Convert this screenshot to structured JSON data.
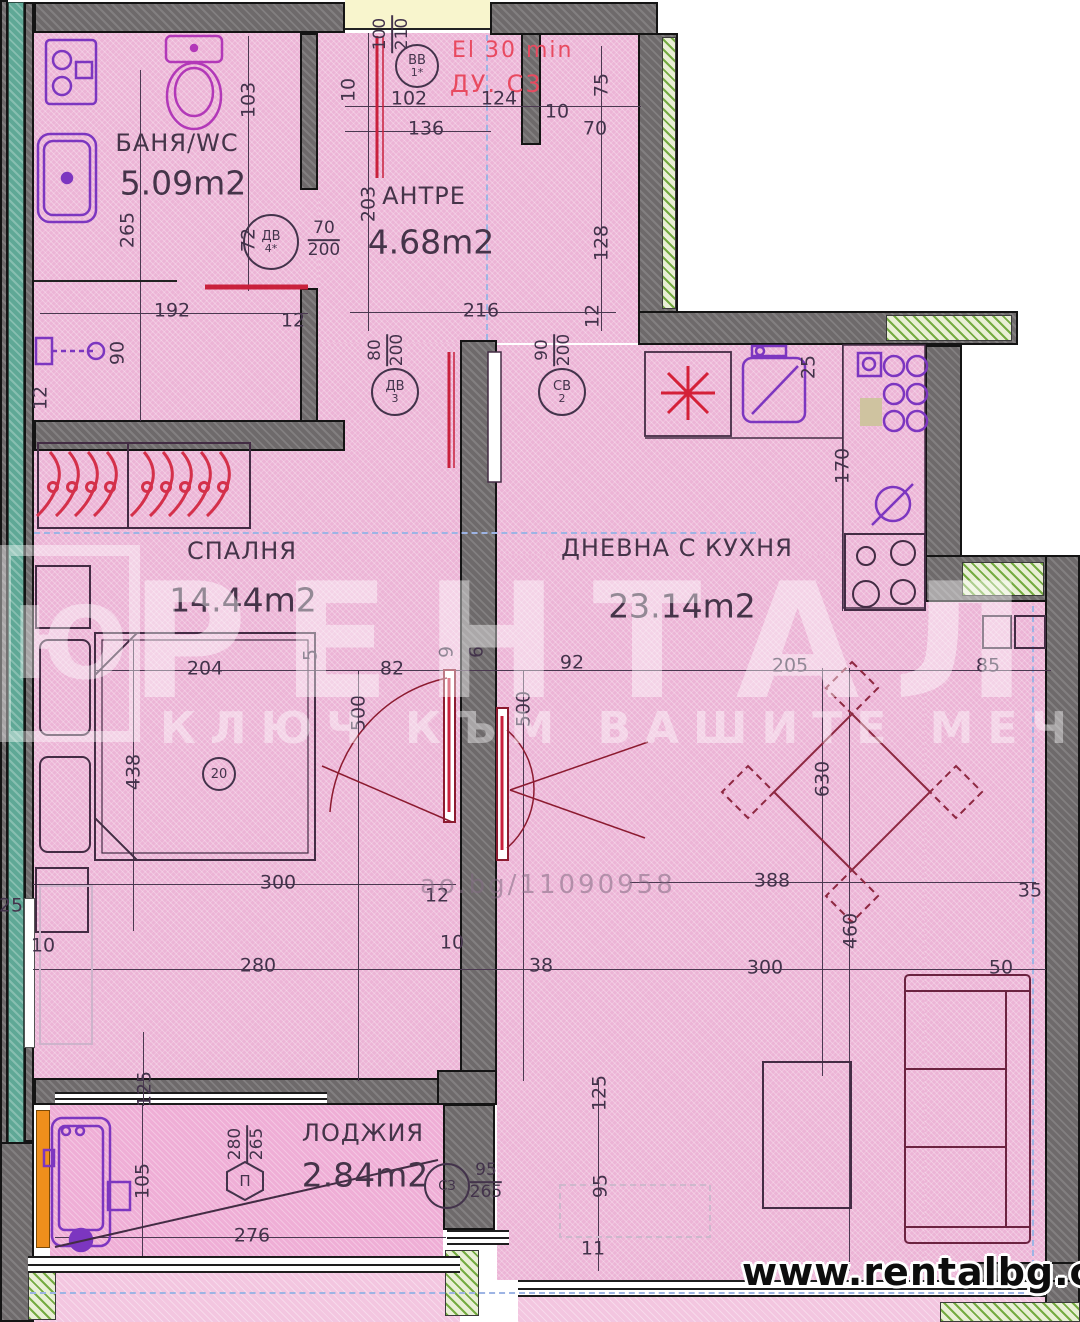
{
  "rooms": [
    {
      "name": "БАНЯ/WC",
      "area": "5.09m2"
    },
    {
      "name": "АНТРЕ",
      "area": "4.68m2"
    },
    {
      "name": "СПАЛНЯ",
      "area": "14.44m2"
    },
    {
      "name": "ДНЕВНА С КУХНЯ",
      "area": "23.14m2"
    },
    {
      "name": "ЛОДЖИЯ",
      "area": "2.84m2"
    }
  ],
  "annotations": {
    "fire_rating": "El 30 min",
    "duct": "ДУ. С3"
  },
  "watermark": {
    "brand": "РЕНТАЛ",
    "tagline": "КЛЮЧ КЪМ ВАШИТЕ МЕЧТИ",
    "logo_letter": "Ю",
    "photo_code": "ao.bg/11090958",
    "site": "www.rentalbg.com"
  },
  "colors": {
    "floor_pink": "#ecb4d6",
    "wall_gray": "#6e6a6b",
    "teal_edge": "#5fa896",
    "insulation_green": "#74ab41",
    "accent_red": "#c9203c",
    "fixture_purple": "#7c36c0",
    "dim_text": "#43334b"
  },
  "tags": [
    {
      "shape": "circle",
      "label": "ВВ",
      "sub": "1*",
      "x": 417,
      "y": 66,
      "d": 40
    },
    {
      "shape": "circle",
      "label": "ДВ",
      "sub": "4*",
      "x": 271,
      "y": 242,
      "d": 52
    },
    {
      "shape": "circle",
      "label": "ДВ",
      "sub": "3",
      "x": 395,
      "y": 392,
      "d": 44
    },
    {
      "shape": "circle",
      "label": "СВ",
      "sub": "2",
      "x": 562,
      "y": 392,
      "d": 44
    },
    {
      "shape": "circle",
      "label": "СЗ",
      "sub": "",
      "x": 447,
      "y": 1186,
      "d": 42
    },
    {
      "shape": "circle",
      "label": "20",
      "sub": "",
      "x": 219,
      "y": 774,
      "d": 30
    },
    {
      "shape": "hex",
      "label": "П",
      "sub": "",
      "x": 245,
      "y": 1181,
      "d": 42
    }
  ],
  "fractions": [
    {
      "num": "100",
      "den": "210",
      "x": 392,
      "y": 34,
      "rot": 1
    },
    {
      "num": "70",
      "den": "200",
      "x": 324,
      "y": 240,
      "rot": 0
    },
    {
      "num": "80",
      "den": "200",
      "x": 387,
      "y": 350,
      "rot": 1
    },
    {
      "num": "90",
      "den": "200",
      "x": 554,
      "y": 350,
      "rot": 1
    },
    {
      "num": "95",
      "den": "265",
      "x": 486,
      "y": 1182,
      "rot": 0
    },
    {
      "num": "280",
      "den": "265",
      "x": 247,
      "y": 1144,
      "rot": 1
    }
  ],
  "dimensions": [
    {
      "t": "265",
      "x": 128,
      "y": 230,
      "r": 1
    },
    {
      "t": "103",
      "x": 249,
      "y": 100,
      "r": 1
    },
    {
      "t": "72",
      "x": 249,
      "y": 240,
      "r": 1
    },
    {
      "t": "192",
      "x": 172,
      "y": 311,
      "r": 0
    },
    {
      "t": "12",
      "x": 293,
      "y": 321,
      "r": 0
    },
    {
      "t": "90",
      "x": 118,
      "y": 353,
      "r": 1
    },
    {
      "t": "12",
      "x": 41,
      "y": 398,
      "r": 1
    },
    {
      "t": "10",
      "x": 349,
      "y": 90,
      "r": 1
    },
    {
      "t": "102",
      "x": 409,
      "y": 99,
      "r": 0
    },
    {
      "t": "136",
      "x": 426,
      "y": 129,
      "r": 0
    },
    {
      "t": "124",
      "x": 499,
      "y": 99,
      "r": 0
    },
    {
      "t": "10",
      "x": 557,
      "y": 112,
      "r": 0
    },
    {
      "t": "70",
      "x": 595,
      "y": 129,
      "r": 0
    },
    {
      "t": "75",
      "x": 602,
      "y": 85,
      "r": 1
    },
    {
      "t": "128",
      "x": 602,
      "y": 243,
      "r": 1
    },
    {
      "t": "203",
      "x": 369,
      "y": 204,
      "r": 1
    },
    {
      "t": "216",
      "x": 481,
      "y": 311,
      "r": 0
    },
    {
      "t": "12",
      "x": 593,
      "y": 316,
      "r": 1
    },
    {
      "t": "204",
      "x": 205,
      "y": 669,
      "r": 0
    },
    {
      "t": "5",
      "x": 311,
      "y": 655,
      "r": 1
    },
    {
      "t": "82",
      "x": 392,
      "y": 669,
      "r": 0
    },
    {
      "t": "9",
      "x": 447,
      "y": 652,
      "r": 1
    },
    {
      "t": "6",
      "x": 477,
      "y": 652,
      "r": 1
    },
    {
      "t": "92",
      "x": 572,
      "y": 663,
      "r": 0
    },
    {
      "t": "500",
      "x": 359,
      "y": 713,
      "r": 1
    },
    {
      "t": "500",
      "x": 524,
      "y": 709,
      "r": 1
    },
    {
      "t": "438",
      "x": 134,
      "y": 772,
      "r": 1
    },
    {
      "t": "12",
      "x": 437,
      "y": 896,
      "r": 0
    },
    {
      "t": "10",
      "x": 452,
      "y": 943,
      "r": 0
    },
    {
      "t": "25",
      "x": 11,
      "y": 906,
      "r": 0
    },
    {
      "t": "10",
      "x": 43,
      "y": 946,
      "r": 0
    },
    {
      "t": "300",
      "x": 278,
      "y": 883,
      "r": 0
    },
    {
      "t": "280",
      "x": 258,
      "y": 966,
      "r": 0
    },
    {
      "t": "38",
      "x": 541,
      "y": 966,
      "r": 0
    },
    {
      "t": "205",
      "x": 790,
      "y": 666,
      "r": 0
    },
    {
      "t": "85",
      "x": 988,
      "y": 666,
      "r": 0
    },
    {
      "t": "630",
      "x": 823,
      "y": 779,
      "r": 1
    },
    {
      "t": "388",
      "x": 772,
      "y": 881,
      "r": 0
    },
    {
      "t": "35",
      "x": 1030,
      "y": 891,
      "r": 0
    },
    {
      "t": "460",
      "x": 851,
      "y": 931,
      "r": 1
    },
    {
      "t": "300",
      "x": 765,
      "y": 968,
      "r": 0
    },
    {
      "t": "50",
      "x": 1001,
      "y": 968,
      "r": 0
    },
    {
      "t": "25",
      "x": 809,
      "y": 367,
      "r": 1
    },
    {
      "t": "170",
      "x": 843,
      "y": 466,
      "r": 1
    },
    {
      "t": "95",
      "x": 601,
      "y": 1186,
      "r": 1
    },
    {
      "t": "125",
      "x": 600,
      "y": 1093,
      "r": 1
    },
    {
      "t": "11",
      "x": 593,
      "y": 1249,
      "r": 0
    },
    {
      "t": "105",
      "x": 143,
      "y": 1181,
      "r": 1
    },
    {
      "t": "125",
      "x": 145,
      "y": 1089,
      "r": 1
    },
    {
      "t": "276",
      "x": 252,
      "y": 1236,
      "r": 0
    }
  ]
}
